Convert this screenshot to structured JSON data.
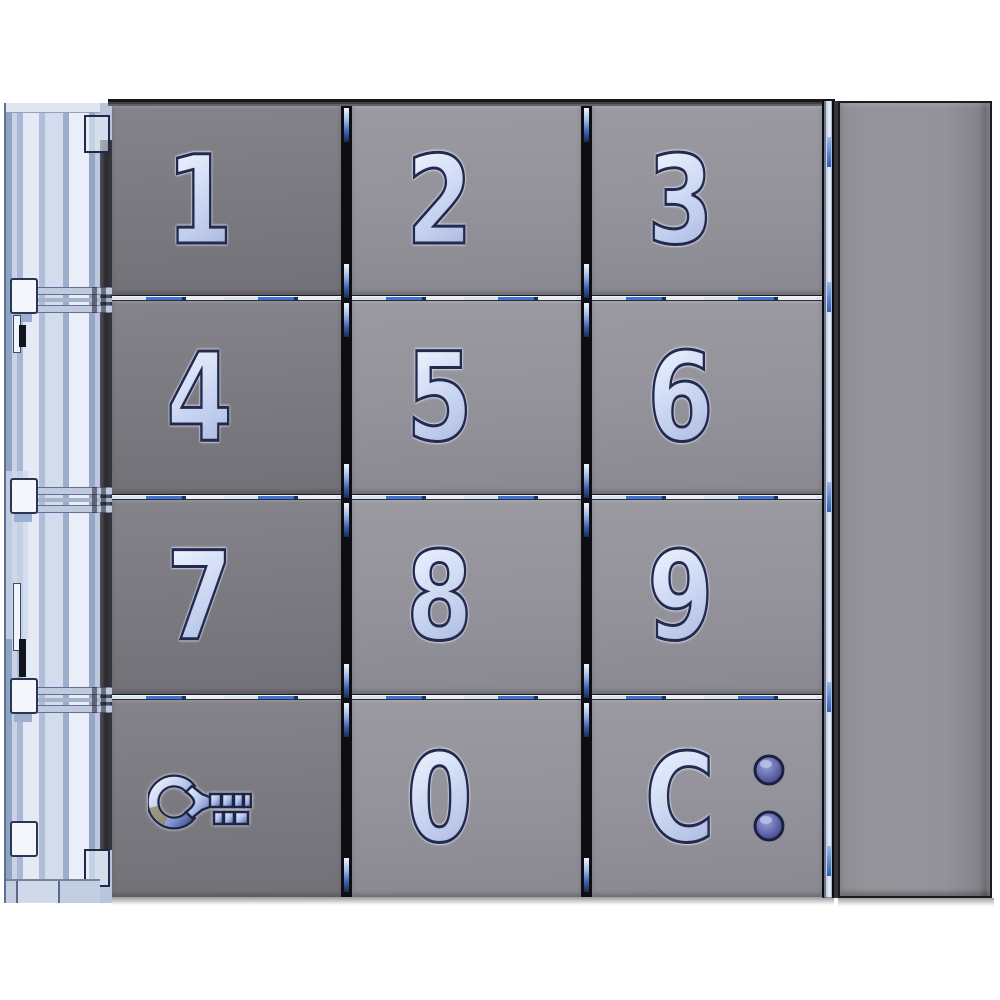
{
  "module": {
    "kind": "door-entry-keypad-front-panel",
    "sections": [
      "mounting-frame-left",
      "keypad-grid",
      "blank-module"
    ]
  },
  "keypad": {
    "rows": 4,
    "cols": 3,
    "keys": [
      {
        "id": "key-1",
        "label": "1"
      },
      {
        "id": "key-2",
        "label": "2"
      },
      {
        "id": "key-3",
        "label": "3"
      },
      {
        "id": "key-4",
        "label": "4"
      },
      {
        "id": "key-5",
        "label": "5"
      },
      {
        "id": "key-6",
        "label": "6"
      },
      {
        "id": "key-7",
        "label": "7"
      },
      {
        "id": "key-8",
        "label": "8"
      },
      {
        "id": "key-9",
        "label": "9"
      },
      {
        "id": "key-unlock",
        "label": "",
        "icon": "key-icon"
      },
      {
        "id": "key-0",
        "label": "0"
      },
      {
        "id": "key-clear",
        "label": "C",
        "icon": "led-colon"
      }
    ],
    "leds": [
      {
        "id": "led-upper",
        "state_color": "#5c61a6"
      },
      {
        "id": "led-lower",
        "state_color": "#5c61a6"
      }
    ]
  },
  "colors": {
    "background": "#ffffff",
    "button_gray": "#93929a",
    "button_gray_dark": "#7c7b82",
    "digit_glass_blue": "#9db2e2",
    "digit_outline": "#232a4e",
    "frame_blue": "#cdd7e9",
    "gap_black": "#0e0e12",
    "divider_blue": "#3d74d8",
    "led_purple": "#5c61a6",
    "blank_module_gray": "#90909a"
  }
}
